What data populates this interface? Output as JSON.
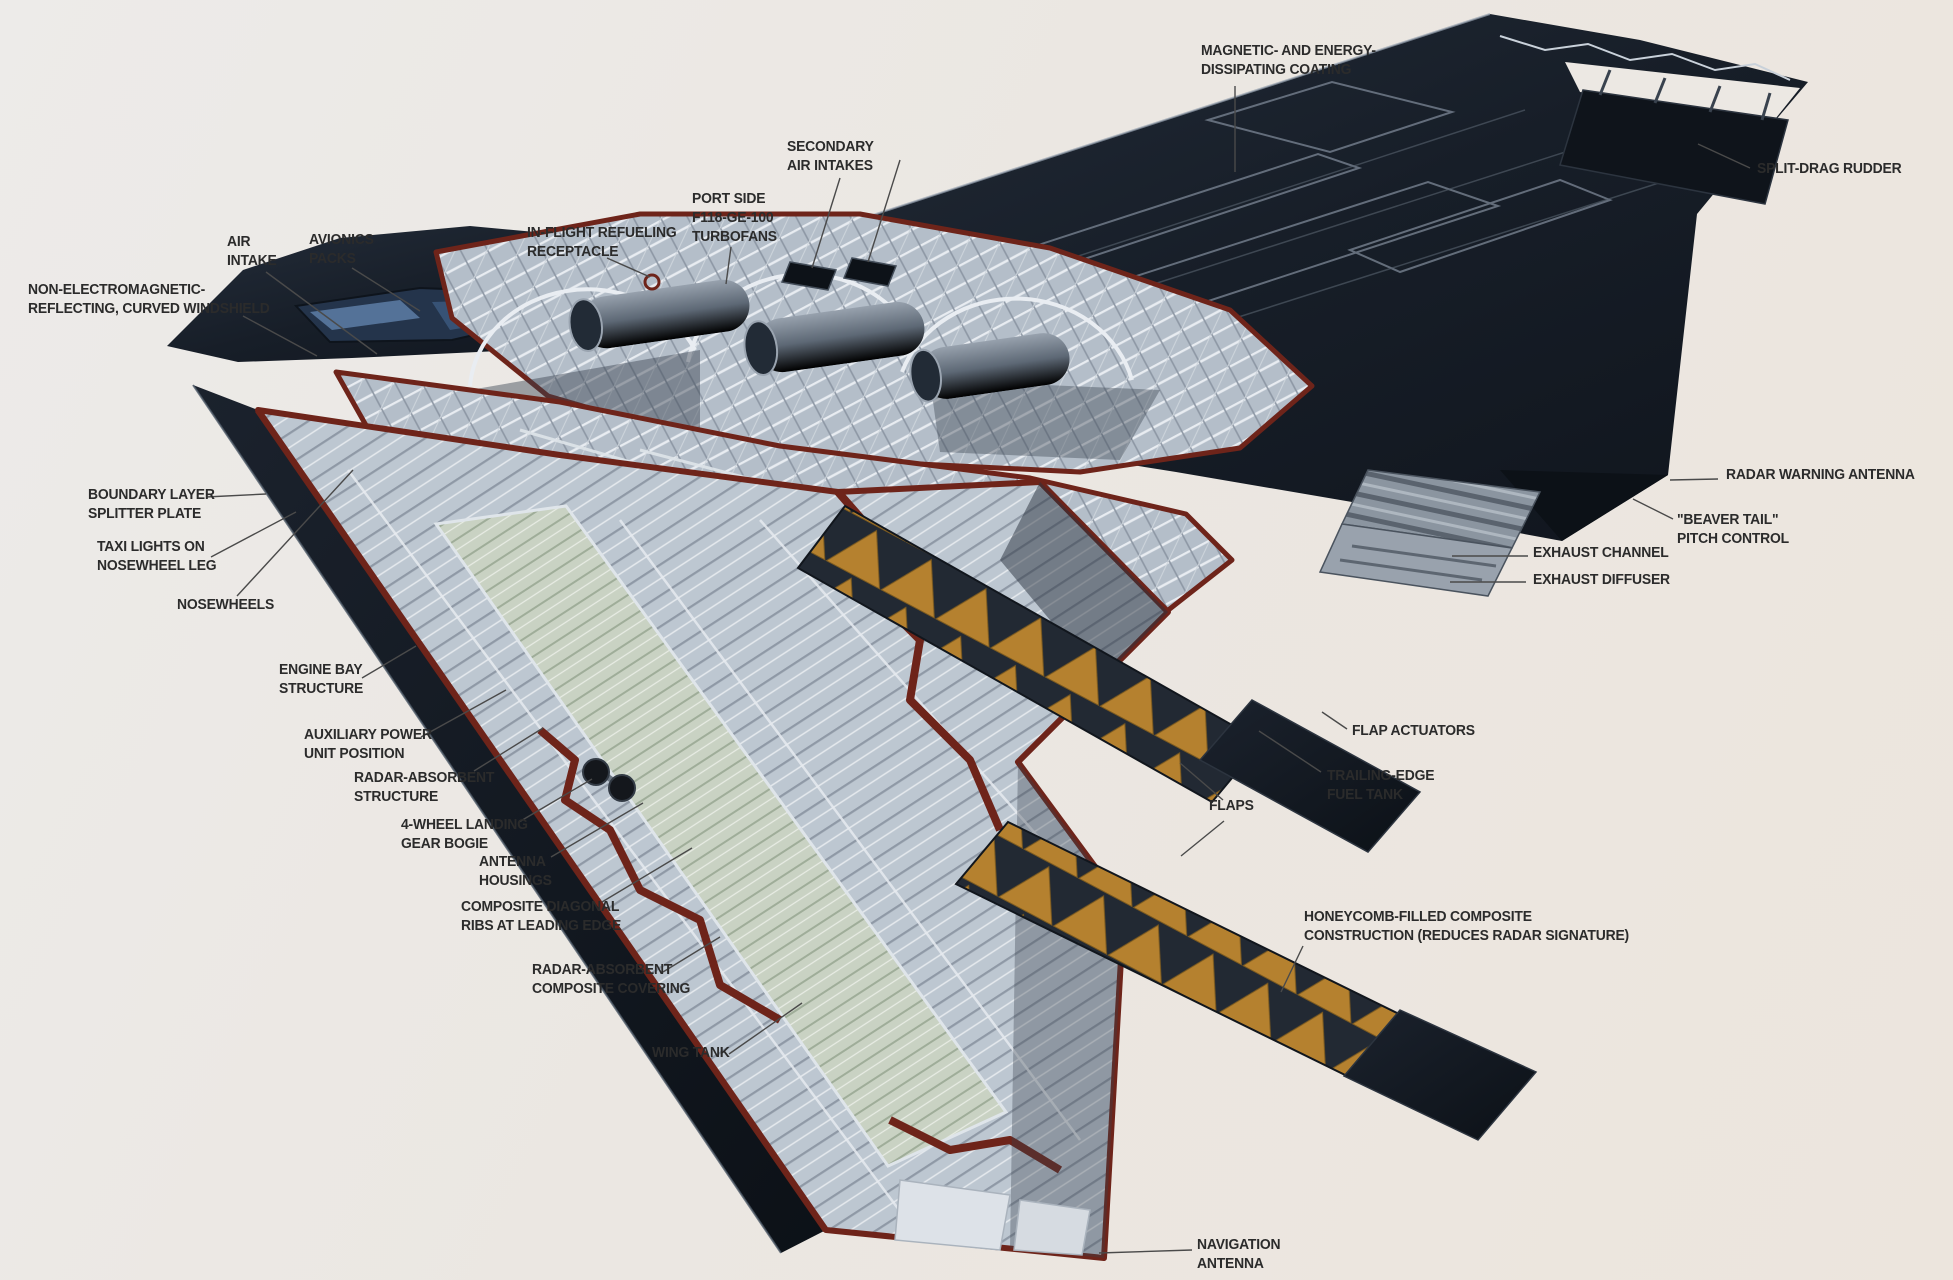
{
  "illustration": {
    "alt": "Cutaway technical illustration of a stealth flying-wing bomber showing internal structure",
    "style": "annotated cutaway diagram with leader lines"
  },
  "colors": {
    "background": "#ece8e2",
    "airframe_dark": "#171e28",
    "cutaway_structure": "#bcc6d0",
    "tear_edge_maroon": "#6e241a",
    "tank_green": "#c8d1c2",
    "honeycomb_orange": "#b5812f",
    "label_text": "#2b2b2b",
    "leader_line": "#4a4a4a"
  },
  "labels": {
    "magnetic_coating": {
      "text": "MAGNETIC- AND ENERGY-\nDISSIPATING COATING"
    },
    "split_drag_rudder": {
      "text": "SPLIT-DRAG RUDDER"
    },
    "secondary_air_intakes": {
      "text": "SECONDARY\nAIR INTAKES"
    },
    "port_side_turbofans": {
      "text": "PORT SIDE\nF118-GE-100\nTURBOFANS"
    },
    "inflight_refueling": {
      "text": "IN-FLIGHT REFUELING\nRECEPTACLE"
    },
    "air_intake": {
      "text": "AIR\nINTAKE"
    },
    "avionics_packs": {
      "text": "AVIONICS\nPACKS"
    },
    "windshield": {
      "text": "NON-ELECTROMAGNETIC-\nREFLECTING, CURVED WINDSHIELD"
    },
    "boundary_layer": {
      "text": "BOUNDARY LAYER\nSPLITTER PLATE"
    },
    "taxi_lights": {
      "text": "TAXI LIGHTS ON\nNOSEWHEEL LEG"
    },
    "nosewheels": {
      "text": "NOSEWHEELS"
    },
    "engine_bay": {
      "text": "ENGINE BAY\nSTRUCTURE"
    },
    "apu": {
      "text": "AUXILIARY POWER\nUNIT POSITION"
    },
    "radar_absorbent_structure": {
      "text": "RADAR-ABSORBENT\nSTRUCTURE"
    },
    "landing_gear_bogie": {
      "text": "4-WHEEL LANDING\nGEAR BOGIE"
    },
    "antenna_housings": {
      "text": "ANTENNA\nHOUSINGS"
    },
    "composite_ribs": {
      "text": "COMPOSITE DIAGONAL\nRIBS AT LEADING EDGE"
    },
    "rac_covering": {
      "text": "RADAR-ABSORBENT\nCOMPOSITE COVERING"
    },
    "wing_tank": {
      "text": "WING TANK"
    },
    "radar_warning_antenna": {
      "text": "RADAR WARNING ANTENNA"
    },
    "beaver_tail": {
      "text": "\"BEAVER TAIL\"\nPITCH CONTROL"
    },
    "exhaust_channel": {
      "text": "EXHAUST CHANNEL"
    },
    "exhaust_diffuser": {
      "text": "EXHAUST DIFFUSER"
    },
    "flap_actuators": {
      "text": "FLAP ACTUATORS"
    },
    "trailing_edge_fuel_tank": {
      "text": "TRAILING-EDGE\nFUEL TANK"
    },
    "flaps": {
      "text": "FLAPS"
    },
    "honeycomb": {
      "text": "HONEYCOMB-FILLED COMPOSITE\nCONSTRUCTION (REDUCES RADAR SIGNATURE)"
    },
    "navigation_antenna": {
      "text": "NAVIGATION\nANTENNA"
    }
  }
}
